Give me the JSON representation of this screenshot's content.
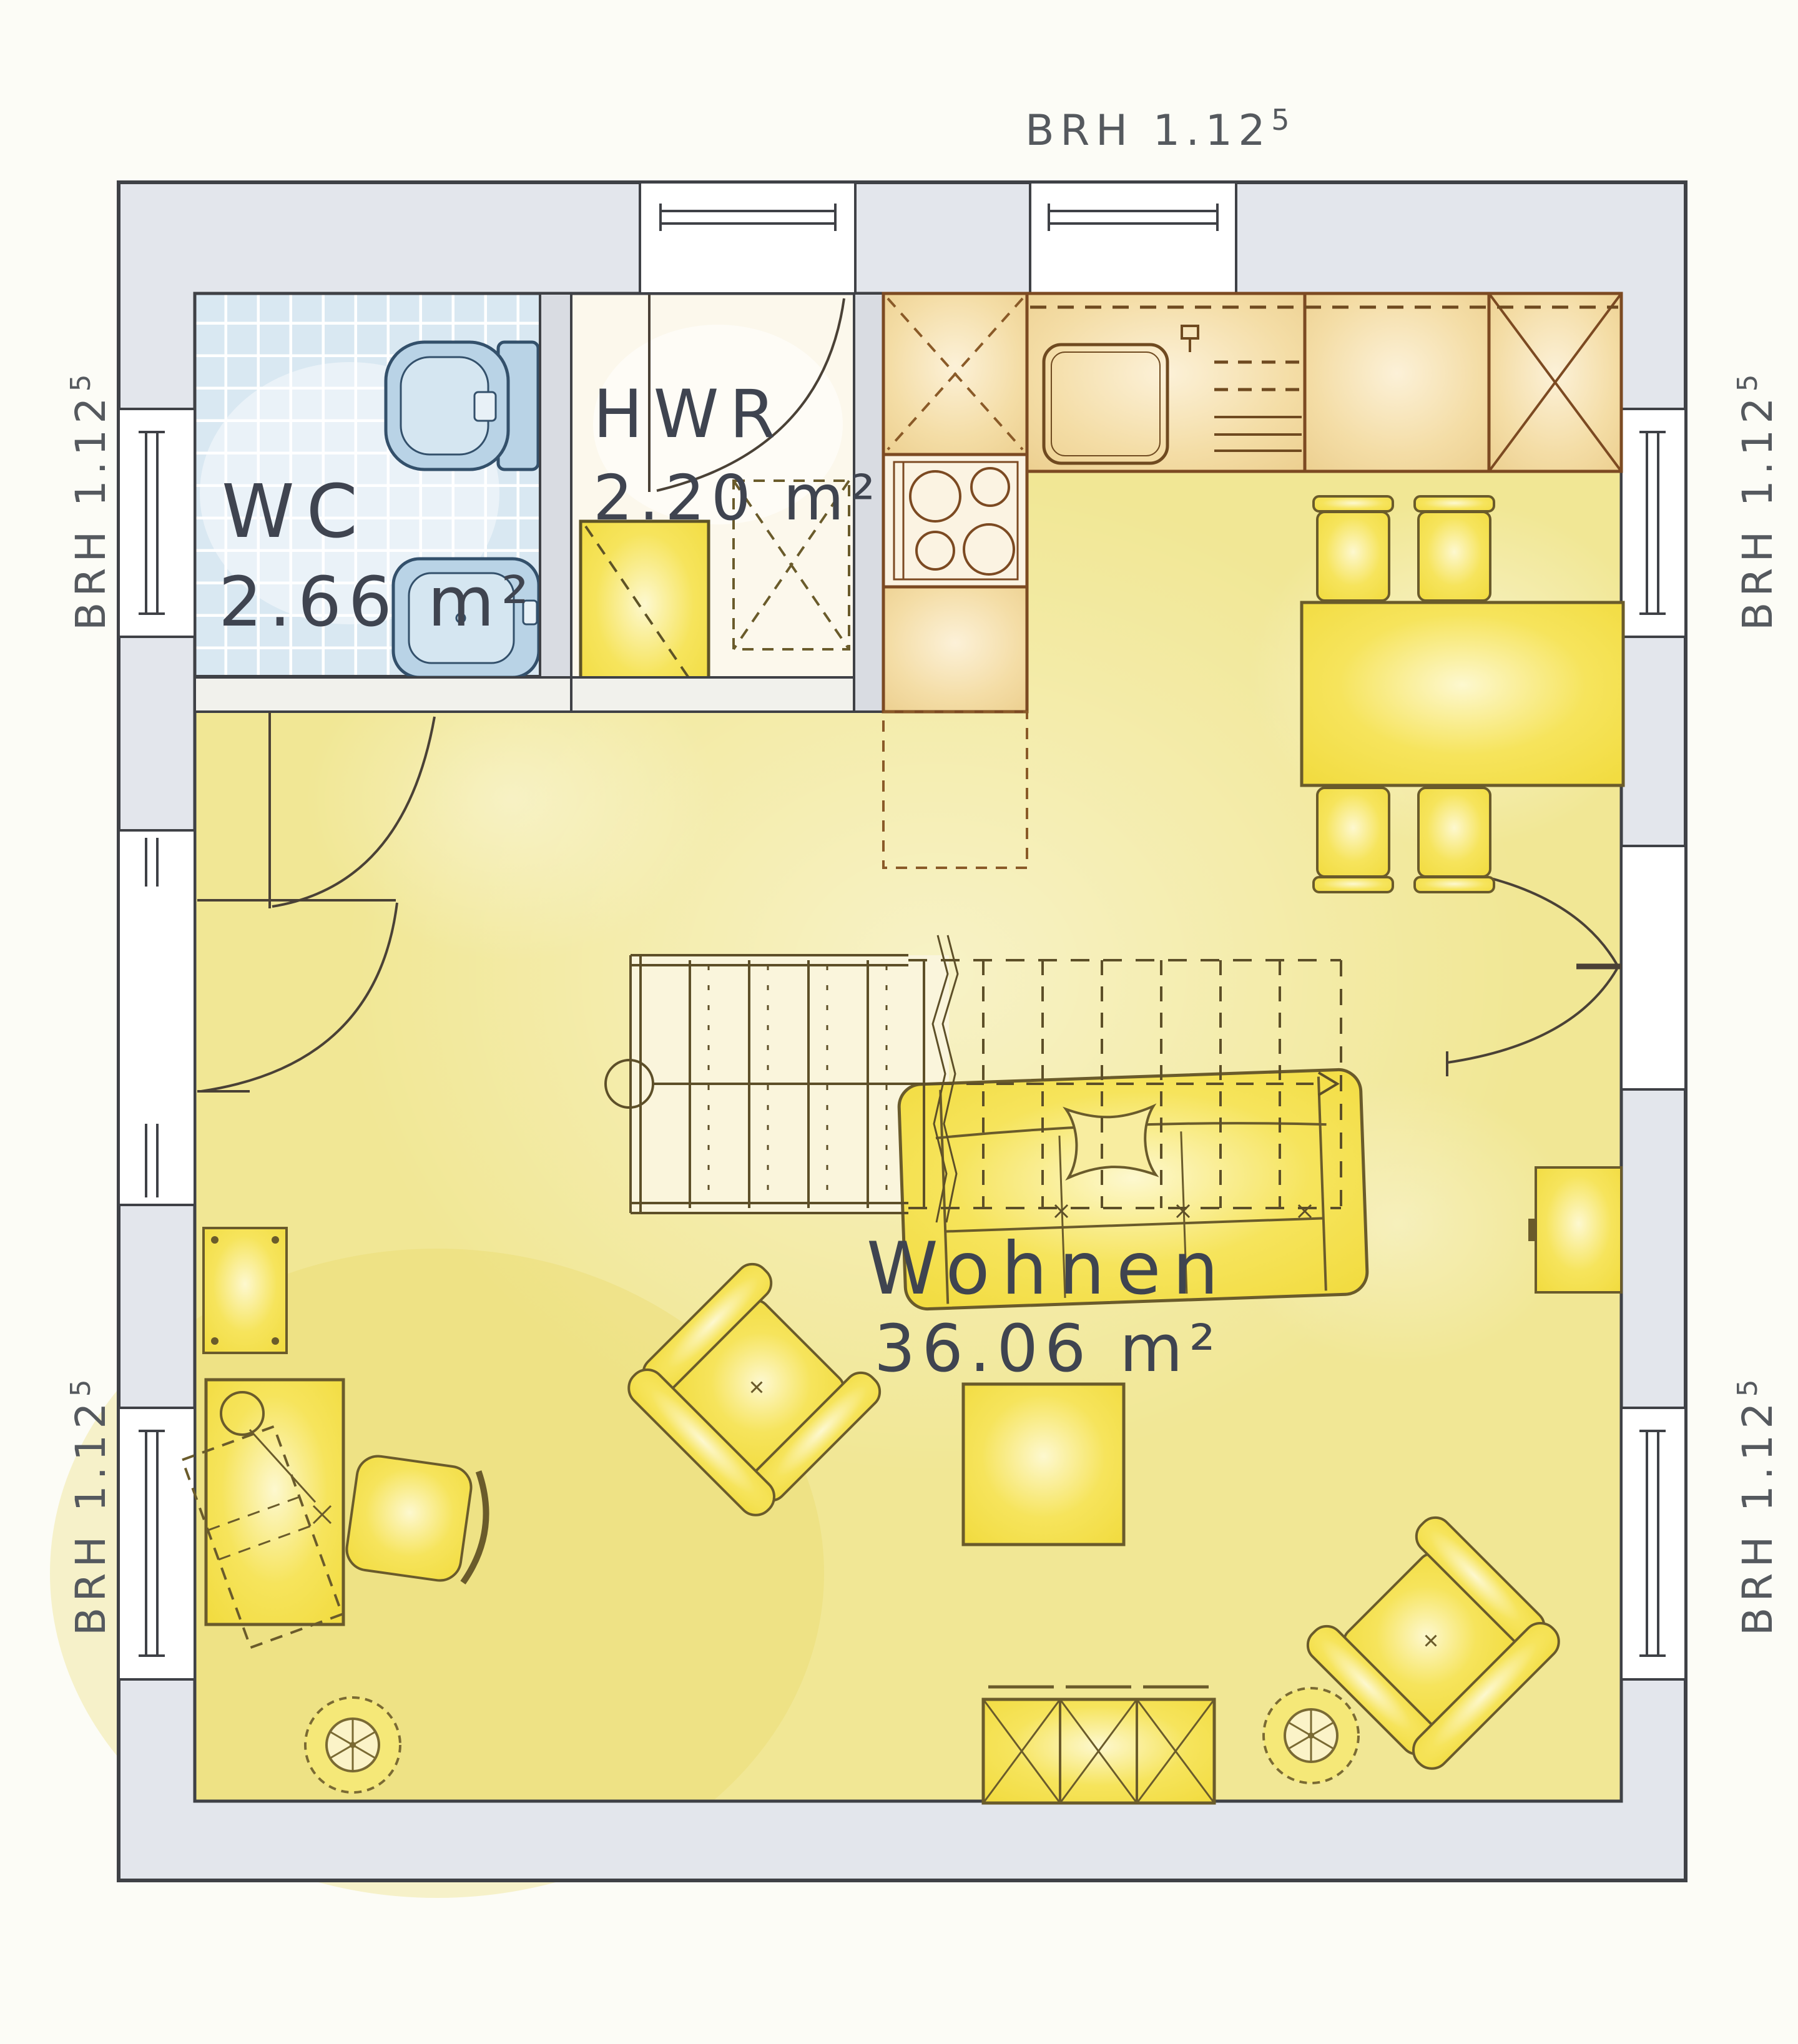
{
  "plan": {
    "window_sill_annotation": {
      "text": "BRH 1.12",
      "sup": "5"
    },
    "rooms": [
      {
        "id": "wc",
        "name": "WC",
        "area": "2.66 m²"
      },
      {
        "id": "hwr",
        "name": "HWR",
        "area": "2.20 m²"
      },
      {
        "id": "wohnen",
        "name": "Wohnen",
        "area": "36.06 m²"
      }
    ],
    "colors": {
      "floor": "#f1e795",
      "furniture": "#f5e24e",
      "kitchen_counter": "#f3d9a1",
      "counter_outline": "#7c4a22",
      "tile": "#d9e8f2",
      "fixture": "#b9d3e6",
      "wall": "#e3e6ec",
      "line": "#3f4146",
      "furniture_outline": "#6a5b2b",
      "label_text": "#3f4450",
      "annotation_text": "#55595e"
    }
  }
}
